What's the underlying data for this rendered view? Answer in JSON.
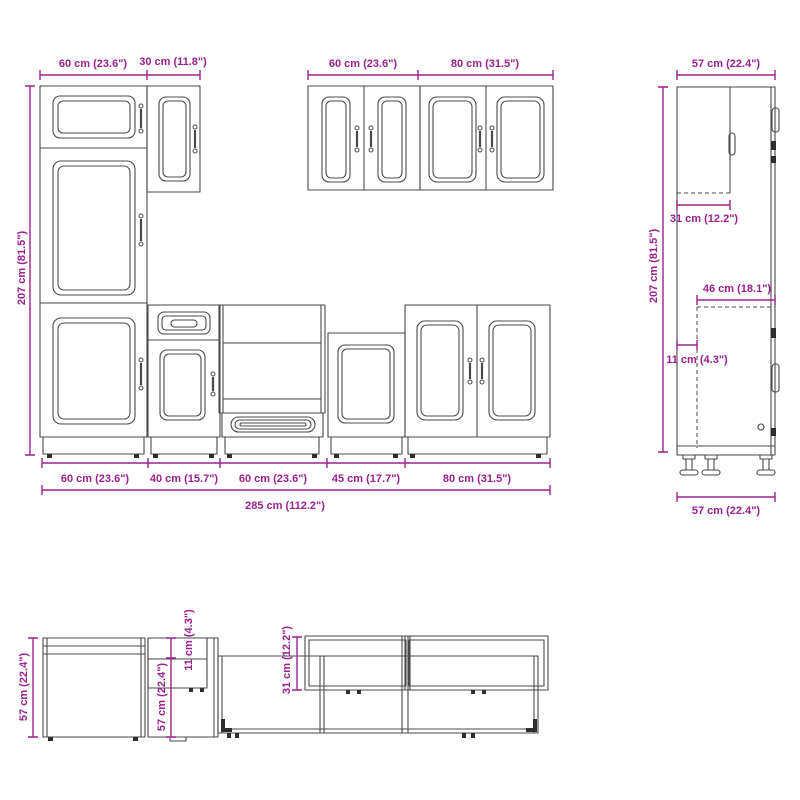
{
  "colors": {
    "dimension": "#9C2190",
    "outline": "#4a4a4a",
    "background": "#ffffff"
  },
  "front_view": {
    "top_dims": [
      "60 cm (23.6\")",
      "30 cm (11.8\")",
      "60 cm (23.6\")",
      "80 cm (31.5\")"
    ],
    "height_dim": "207 cm (81.5\")",
    "bottom_dims": [
      "60 cm (23.6\")",
      "40 cm (15.7\")",
      "60 cm (23.6\")",
      "45 cm (17.7\")",
      "80 cm (31.5\")"
    ],
    "total_width_dim": "285 cm (112.2\")"
  },
  "side_view": {
    "width_top_dim": "57 cm (22.4\")",
    "height_dim": "207 cm (81.5\")",
    "upper_depth_dim": "31 cm (12.2\")",
    "inner_depth_dim": "46 cm (18.1\")",
    "front_offset_dim": "11 cm (4.3\")",
    "width_bottom_dim": "57 cm (22.4\")"
  },
  "plan_view": {
    "depth_left_dim": "57 cm (22.4\")",
    "depth_base_dim": "57 cm (22.4\")",
    "front_offset_dim": "11 cm (4.3\")",
    "wall_depth_dim": "31 cm (12.2\")"
  }
}
